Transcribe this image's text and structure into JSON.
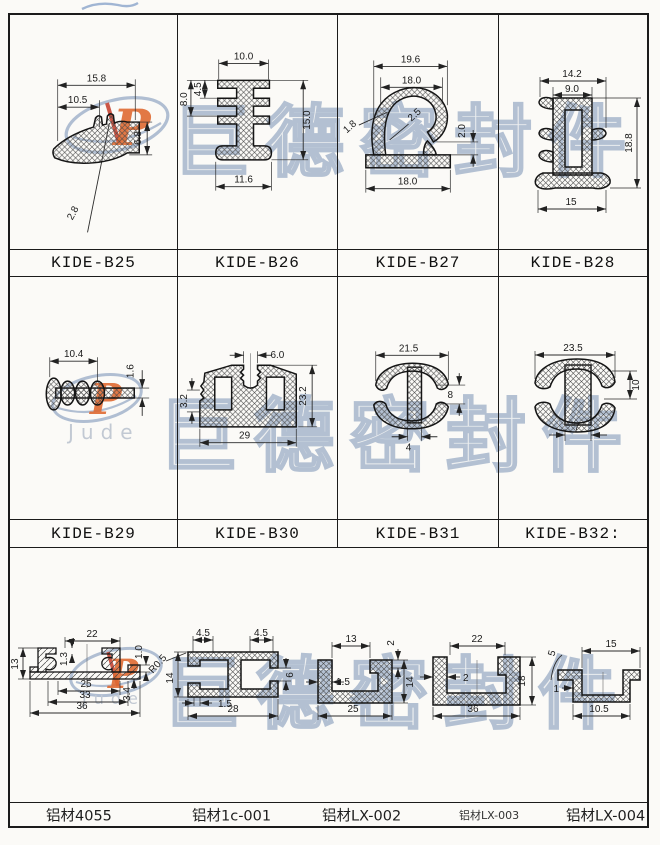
{
  "watermark": {
    "text": "巨德密封件",
    "brand": "Jude",
    "brand_initial": "P"
  },
  "seals": {
    "b25": {
      "label": "KIDE-B25",
      "dims": {
        "top": "15.8",
        "top2": "10.5",
        "right": "6.8",
        "thickness": "2.8"
      }
    },
    "b26": {
      "label": "KIDE-B26",
      "dims": {
        "top": "10.0",
        "left_inner": "4.5",
        "left": "8.0",
        "right": "15.0",
        "bottom": "11.6"
      }
    },
    "b27": {
      "label": "KIDE-B27",
      "dims": {
        "top": "19.6",
        "top2": "18.0",
        "wall": "2.5",
        "wall2": "1.8",
        "right": "2.0",
        "bottom": "18.0"
      }
    },
    "b28": {
      "label": "KIDE-B28",
      "dims": {
        "top": "14.2",
        "top2": "9.0",
        "right": "18.8",
        "bottom": "15"
      }
    },
    "b29": {
      "label": "KIDE-B29",
      "dims": {
        "top": "10.4",
        "right": "1.6"
      }
    },
    "b30": {
      "label": "KIDE-B30",
      "dims": {
        "top": "6.0",
        "left": "3.2",
        "right": "23.2",
        "bottom": "29"
      }
    },
    "b31": {
      "label": "KIDE-B31",
      "dims": {
        "top": "21.5",
        "right": "8",
        "bottom": "4"
      }
    },
    "b32": {
      "label": "KIDE-B32:",
      "dims": {
        "top": "23.5",
        "right": "10",
        "bottom": "7"
      }
    }
  },
  "aluminum": {
    "a4055": {
      "label": "铝材4055",
      "dims": {
        "top": "22",
        "left": "13",
        "inner": "1.3",
        "b1": "25",
        "b2": "33",
        "b3": "36",
        "r1": "1.0",
        "r2": "3.4"
      }
    },
    "a1c001": {
      "label": "铝材1c-001",
      "dims": {
        "t1": "4.5",
        "t2": "4.5",
        "radius": "R0.5",
        "left": "14",
        "right": "6",
        "b1": "1.5",
        "b2": "28"
      }
    },
    "lx002": {
      "label": "铝材LX-002",
      "dims": {
        "top": "13",
        "tr": "2",
        "left": "1.5",
        "right": "14",
        "bottom": "25"
      }
    },
    "lx003": {
      "label": "铝材LX-003",
      "dims": {
        "top": "22",
        "left": "2",
        "right": "18",
        "bottom": "36"
      }
    },
    "lx004": {
      "label": "铝材LX-004",
      "dims": {
        "tl": "5",
        "top": "15",
        "left": "1",
        "bottom": "10.5"
      }
    }
  },
  "colors": {
    "line": "#1b1b1b",
    "watermark": "#b3c0d2",
    "accent_orange": "#e06a32",
    "accent_red": "#c43a28"
  }
}
